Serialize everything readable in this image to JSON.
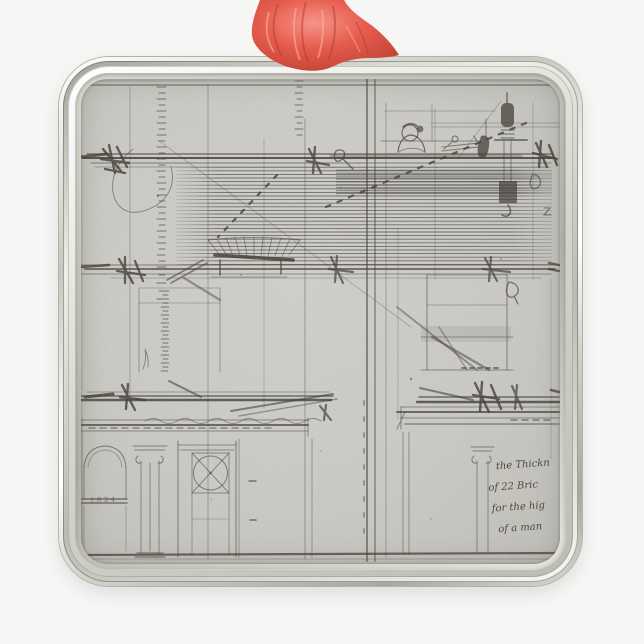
{
  "scene": {
    "background_color": "#f6f6f4",
    "subject": "square chrome metal ornament with red ribbon, printed with a pencil sketch of scaffolding on a building facade"
  },
  "ribbon": {
    "label": "red satin ribbon",
    "color": "#e25b4d"
  },
  "frame": {
    "label": "silver square frame",
    "color": "#d8d8d0",
    "lip_color": "#b1b1a7"
  },
  "artwork": {
    "label": "pencil sketch of scaffolding",
    "paper_color": "#d1d0c9",
    "pencil_color": "#45423c",
    "annotation_lines": [
      "the Thickn",
      "of 22 Bric",
      "for the hig",
      "of a man"
    ],
    "inscription": "1824"
  }
}
